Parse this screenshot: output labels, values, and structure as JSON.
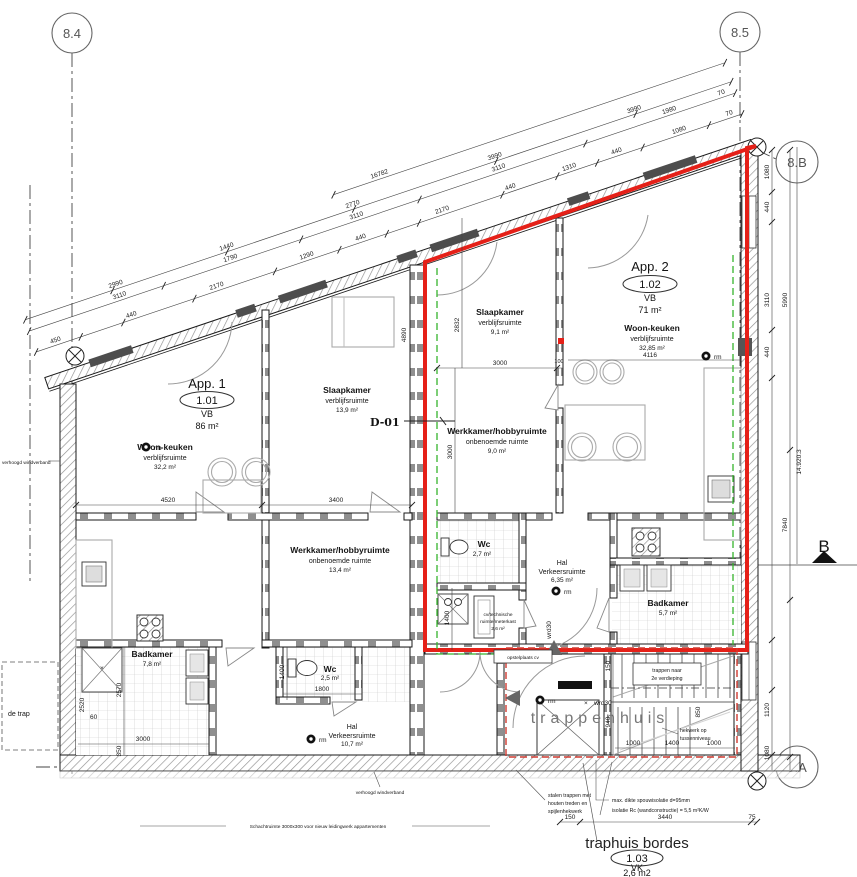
{
  "grid": {
    "c84": "8.4",
    "c85": "8.5",
    "c8B": "8.B",
    "c8A": "8.A",
    "section_b": "B"
  },
  "app1": {
    "name": "App. 1",
    "number": "1.01",
    "level": "VB",
    "area": "86 m²",
    "woonkeuken": {
      "name": "Woon-keuken",
      "type": "verblijfsruimte",
      "area": "32,2 m²"
    },
    "slaapkamer": {
      "name": "Slaapkamer",
      "type": "verblijfsruimte",
      "area": "13,9 m²"
    },
    "werkkamer": {
      "name": "Werkkamer/hobbyruimte",
      "type": "onbenoemde ruimte",
      "area": "13,4 m²"
    },
    "badkamer": {
      "name": "Badkamer",
      "area": "7,8 m²"
    },
    "wc": {
      "name": "Wc",
      "area": "2,5 m²"
    },
    "hal": {
      "name": "Hal",
      "type": "Verkeersruimte",
      "area": "10,7 m²"
    }
  },
  "app2": {
    "name": "App. 2",
    "number": "1.02",
    "level": "VB",
    "area": "71 m²",
    "woonkeuken": {
      "name": "Woon-keuken",
      "type": "verblijfsruimte",
      "area": "32,85 m²"
    },
    "slaapkamer": {
      "name": "Slaapkamer",
      "type": "verblijfsruimte",
      "area": "9,1 m²"
    },
    "werkkamer": {
      "name": "Werkkamer/hobbyruimte",
      "type": "onbenoemde ruimte",
      "area": "9,0 m²"
    },
    "badkamer": {
      "name": "Badkamer",
      "area": "5,7 m²"
    },
    "wc": {
      "name": "Wc",
      "area": "2,7 m²"
    },
    "hal": {
      "name": "Hal",
      "type": "Verkeersruimte",
      "area": "6,35 m²"
    },
    "cv": {
      "line1": "cv/technische",
      "line2": "ruimte/meterkast",
      "area": "2,6 m²"
    }
  },
  "stairwell": {
    "label": "trappenhuis",
    "bordes": {
      "name": "traphuis bordes",
      "number": "1.03",
      "level": "VK",
      "area": "2,6 m2"
    },
    "box1_line1": "trappen naar",
    "box1_line2": "2e verdieping",
    "box2": "opstelplaats cv",
    "hekwerk_line1": "hekwerk op",
    "hekwerk_line2": "tussenniveau"
  },
  "notes": {
    "windverband": "verhoogd windverband",
    "schacht": "Schachtruimte 3000x300 voor nieuw leidingwerk appartementen",
    "stalen1": "stalen trappen met",
    "stalen2": "houten treden en",
    "stalen3": "spijlenhekwerk",
    "isolatie1": "max. dikte spouwisolatie d=95mm",
    "isolatie2": "isolatie Rc (wandconstructie) = 5,5 m²K/W",
    "de_trap": "de trap",
    "d01": "D-01",
    "wrd30": "wrd30",
    "rm": "rm",
    "x_mark": "×"
  },
  "dims": {
    "total": "16782",
    "row1": [
      "450",
      "440",
      "2170",
      "1290",
      "440",
      "2170",
      "440",
      "1310",
      "440",
      "1080",
      "70"
    ],
    "row2": [
      "2990",
      "1440",
      "2770",
      "3990",
      "3990"
    ],
    "row3": [
      "3110",
      "1790",
      "3110",
      "3110",
      "1980",
      "70"
    ],
    "right": [
      "1080",
      "440",
      "3110",
      "5990",
      "440",
      "14.920.3",
      "7840",
      "1120",
      "1080"
    ],
    "left": [
      "2520",
      "60",
      "2570",
      "350",
      "1400"
    ],
    "app1": [
      "4520",
      "3400",
      "4890",
      "3000",
      "1800"
    ],
    "app2": [
      "2832",
      "3000",
      "100",
      "3000",
      "4116",
      "1400"
    ],
    "stairs": [
      "150",
      "940",
      "850",
      "1000",
      "1400",
      "1000"
    ],
    "bottom": [
      "150",
      "3440",
      "75"
    ]
  },
  "colors": {
    "highlight_red": "#e52018",
    "new_green": "#36b42d",
    "zone_red_dashed": "#cf3a30"
  }
}
